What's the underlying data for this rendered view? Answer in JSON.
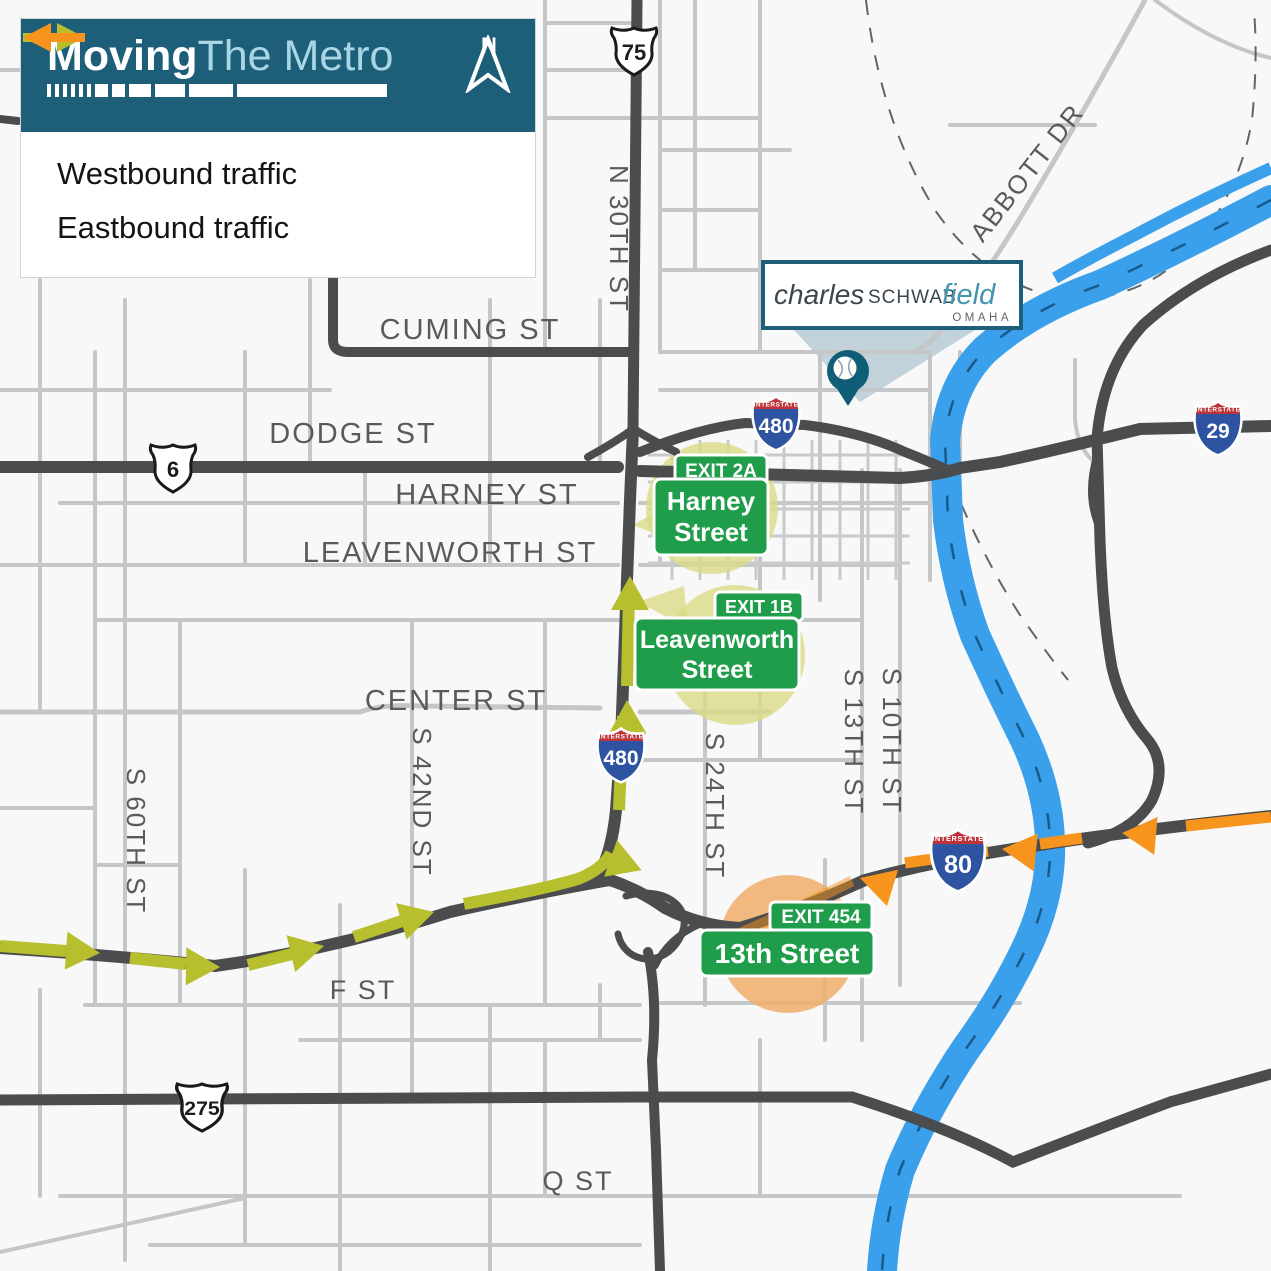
{
  "panel": {
    "brand_bold": "Moving",
    "brand_light": "The Metro",
    "north": "N",
    "legend": [
      {
        "label": "Westbound traffic"
      },
      {
        "label": "Eastbound traffic"
      }
    ]
  },
  "venue": {
    "script": "charles",
    "caps": "SCHWAB",
    "italic": "field",
    "city": "OMAHA"
  },
  "exits": [
    {
      "tab": "EXIT 2A",
      "line1": "Harney",
      "line2": "Street"
    },
    {
      "tab": "EXIT 1B",
      "line1": "Leavenworth",
      "line2": "Street"
    },
    {
      "tab": "EXIT 454",
      "line1": "13th Street"
    }
  ],
  "shields": {
    "interstate": "INTERSTATE",
    "us75": "75",
    "us6": "6",
    "us275": "275",
    "i480": "480",
    "i80": "80",
    "i29": "29"
  },
  "streets": {
    "cuming": "CUMING ST",
    "dodge": "DODGE ST",
    "harney": "HARNEY ST",
    "leavenworth": "LEAVENWORTH ST",
    "center": "CENTER ST",
    "f": "F ST",
    "q": "Q ST",
    "n30": "N 30TH ST",
    "s60": "S 60TH ST",
    "s42": "S 42ND ST",
    "s24": "S 24TH ST",
    "s13": "S 13TH ST",
    "s10": "S 10TH ST",
    "abbott": "ABBOTT DR"
  },
  "colors": {
    "panel_teal": "#1d5f78",
    "sign_green": "#1f9d4b",
    "river": "#3aa0eb",
    "road_dark": "#4b4c4e",
    "road_gray": "#c5c6c8",
    "halo_yellow": "#dadb86",
    "halo_orange": "#f0ae6b",
    "westbound": "#b8bf2f",
    "eastbound": "#f7941e"
  }
}
